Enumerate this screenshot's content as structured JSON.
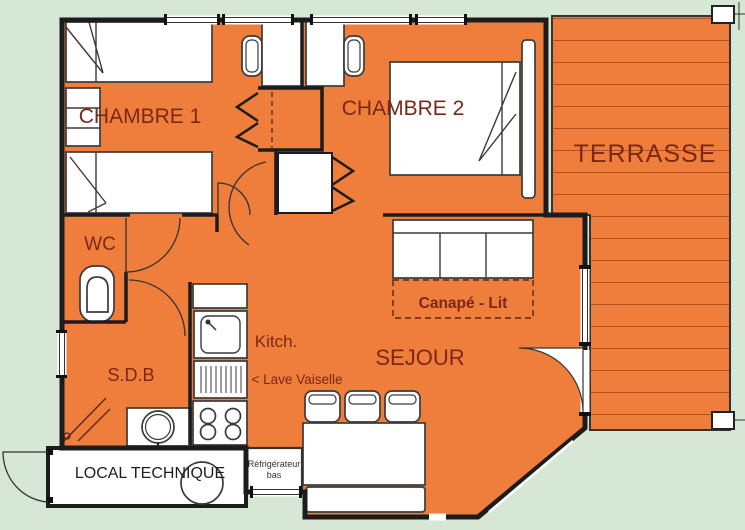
{
  "plan": {
    "rooms": {
      "chambre1": "CHAMBRE 1",
      "chambre2": "CHAMBRE 2",
      "terrasse": "TERRASSE",
      "wc": "WC",
      "sdb": "S.D.B",
      "kitchen": "Kitch.",
      "sejour": "SEJOUR",
      "local_technique": "LOCAL TECHNIQUE"
    },
    "annotations": {
      "canape_lit": "Canapé - Lit",
      "lave_vaiselle": "< Lave Vaiselle",
      "refrigerateur_line1": "Réfrigérateur",
      "refrigerateur_line2": "bas"
    },
    "colors": {
      "floor": "#EF7D3B",
      "background": "#D6E8D5",
      "wall": "#1C1C1C",
      "room_label": "#7B2817",
      "deck_line": "#8A3A15",
      "furniture_fill": "#FFFFFF"
    }
  }
}
